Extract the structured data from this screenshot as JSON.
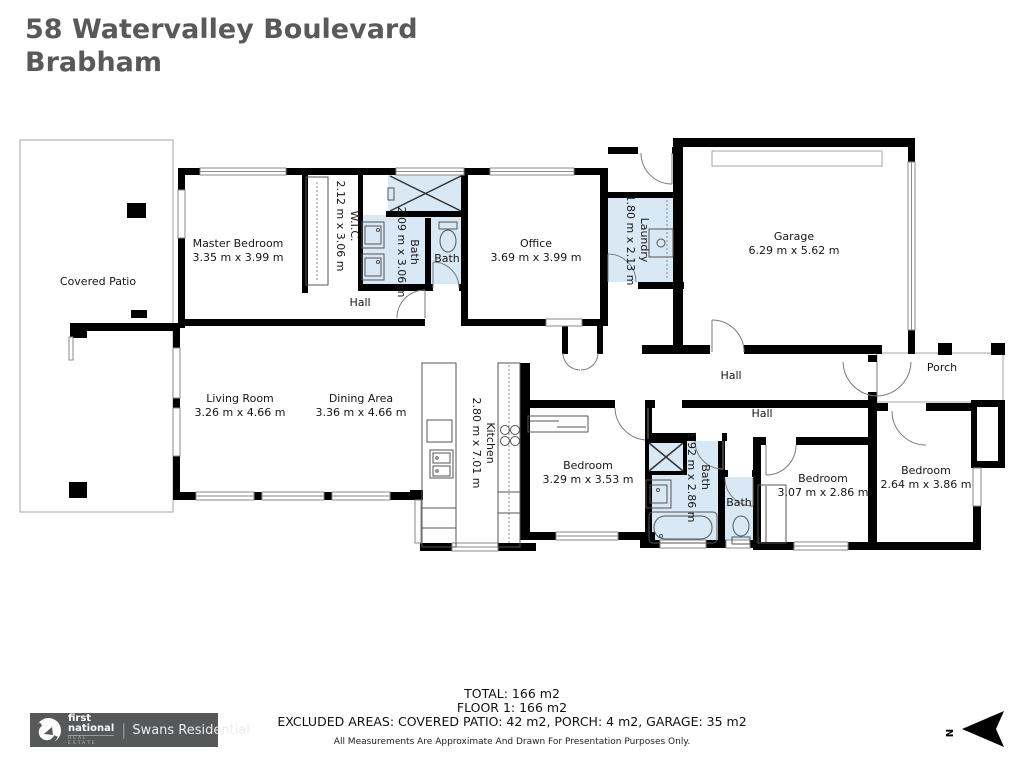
{
  "header": {
    "address_line1": "58 Watervalley Boulevard",
    "address_line2": "Brabham"
  },
  "rooms": {
    "master_bedroom": {
      "name": "Master Bedroom",
      "dims": "3.35 m x 3.99 m"
    },
    "wic": {
      "name": "W.I.C.",
      "dims": "2.12 m x 3.06 m"
    },
    "ensuite": {
      "name": "Bath",
      "dims": "2.09 m x 3.06 m"
    },
    "ensuite_wc": {
      "name": "Bath"
    },
    "office": {
      "name": "Office",
      "dims": "3.69 m x 3.99 m"
    },
    "laundry": {
      "name": "Laundry",
      "dims": "1.80 m x 2.13 m"
    },
    "garage": {
      "name": "Garage",
      "dims": "6.29 m x 5.62 m"
    },
    "covered_patio": {
      "name": "Covered Patio"
    },
    "hall_upper": {
      "name": "Hall"
    },
    "hall_mid": {
      "name": "Hall"
    },
    "hall_lower": {
      "name": "Hall"
    },
    "living_room": {
      "name": "Living Room",
      "dims": "3.26 m x 4.66 m"
    },
    "dining_area": {
      "name": "Dining Area",
      "dims": "3.36 m x 4.66 m"
    },
    "kitchen": {
      "name": "Kitchen",
      "dims": "2.80 m x 7.01 m"
    },
    "bedroom1": {
      "name": "Bedroom",
      "dims": "3.29 m x 3.53 m"
    },
    "main_bath": {
      "name": "Bath",
      "dims": "1.92 m x 2.86 m"
    },
    "main_wc": {
      "name": "Bath"
    },
    "bedroom2": {
      "name": "Bedroom",
      "dims": "3.07 m x 2.86 m"
    },
    "bedroom3": {
      "name": "Bedroom",
      "dims": "2.64 m x 3.86 m"
    },
    "porch": {
      "name": "Porch"
    }
  },
  "summary": {
    "total": "TOTAL: 166 m2",
    "floor": "FLOOR 1: 166 m2",
    "excluded": "EXCLUDED AREAS: COVERED PATIO: 42 m2, PORCH: 4 m2, GARAGE: 35 m2",
    "disclaimer": "All Measurements Are Approximate And Drawn For Presentation Purposes Only."
  },
  "logo": {
    "name_top": "first",
    "name_bottom": "national",
    "tagline": "REAL ESTATE",
    "agency": "Swans Residential"
  },
  "compass": {
    "north_label": "N"
  },
  "colors": {
    "wall": "#000000",
    "wet_area": "#d9e8f5",
    "title_text": "#595959",
    "logo_background": "#57585a"
  }
}
